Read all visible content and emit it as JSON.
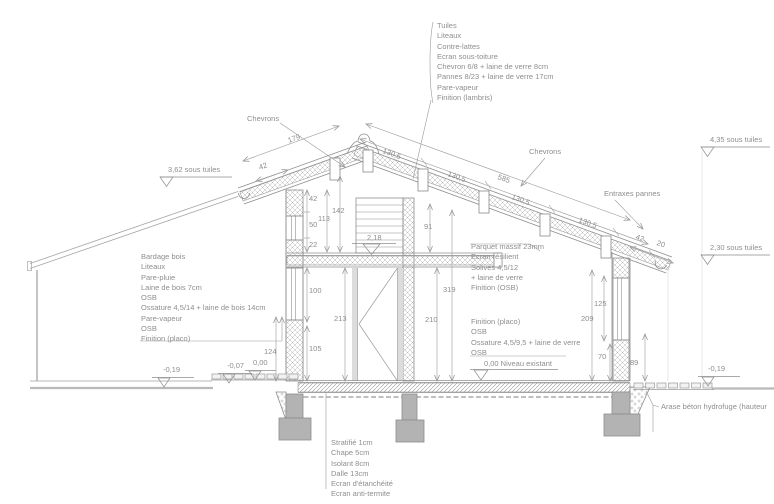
{
  "drawing_title": "Coupe transversale maison ossature bois",
  "colors": {
    "line": "#a0a0a0",
    "text": "#8e8e8e",
    "concrete_fill": "#b3b3b3",
    "hatch": "#b5b5b5",
    "background": "#ffffff"
  },
  "annotations": {
    "chevrons_left": "Chevrons",
    "chevrons_right": "Chevrons",
    "entraxes_pannes": "Entraxes pannes",
    "arase_note": "Arase béton hydrofuge (hauteur",
    "roof_right_layers": [
      "Tuiles",
      "Liteaux",
      "Contre-lattes",
      "Ecran sous-toiture",
      "Chevron 6/8 + laine de verre 8cm",
      "Pannes 8/23 + laine de verre 17cm",
      "Pare-vapeur",
      "Finition (lambris)"
    ],
    "wall_left_layers": [
      "Bardage bois",
      "Liteaux",
      "Pare-pluie",
      "Laine de bois 7cm",
      "OSB",
      "Ossature 4,5/14 + laine de bois 14cm",
      "Pare-vapeur",
      "OSB",
      "Finition (placo)"
    ],
    "mezzanine_floor_layers": [
      "Parquet massif 23mm",
      "Ecran résilient",
      "Solives 4,5/12",
      "+ laine de verre",
      "Finition (OSB)"
    ],
    "partition_layers": [
      "Finition (placo)",
      "OSB",
      "Ossature 4,5/9,5 + laine de verre",
      "OSB"
    ],
    "ground_slab_layers": [
      "Stratifié 1cm",
      "Chape 5cm",
      "Isolant 8cm",
      "Dalle 13cm",
      "Ecran d'étanchéité",
      "Ecran anti-termite"
    ]
  },
  "levels": {
    "left_roof": "3,62 sous tuiles",
    "ridge_right": "4,35 sous tuiles",
    "right_eave": "2,30 sous tuiles",
    "mezzanine": "2,18",
    "existing_floor": "0,00 Niveau existant",
    "ground_left": "-0,19",
    "terrace_left": "-0,07",
    "slab_left": "0,00",
    "ground_right": "-0,19"
  },
  "dims": {
    "rafter_length_left": "179",
    "overhang_left": "42",
    "slope_total": "585",
    "purlin_spacing": [
      "130,5",
      "130,5",
      "130,5",
      "130,5"
    ],
    "overhang_right": "42",
    "eave_edge": "20",
    "heights": {
      "h42": "42",
      "h50": "50",
      "h22": "22",
      "h113": "113",
      "h142": "142",
      "h91": "91",
      "h100": "100",
      "h213": "213",
      "h105": "105",
      "h124": "124",
      "h210": "210",
      "h319": "319",
      "h125": "125",
      "h209": "209",
      "h70": "70",
      "h89": "89"
    }
  }
}
